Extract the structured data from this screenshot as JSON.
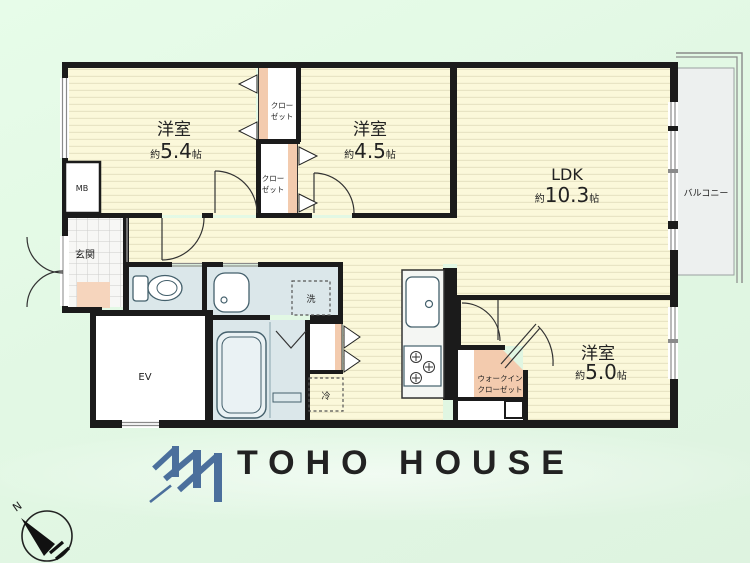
{
  "plan": {
    "room1": {
      "name": "洋室",
      "area_prefix": "約",
      "area_value": "5.4",
      "area_unit": "帖"
    },
    "room2": {
      "name": "洋室",
      "area_prefix": "約",
      "area_value": "4.5",
      "area_unit": "帖"
    },
    "ldk": {
      "name": "LDK",
      "area_prefix": "約",
      "area_value": "10.3",
      "area_unit": "帖"
    },
    "room3": {
      "name": "洋室",
      "area_prefix": "約",
      "area_value": "5.0",
      "area_unit": "帖"
    },
    "balcony": "バルコニー",
    "entrance": "玄関",
    "meter_box": "MB",
    "elevator": "EV",
    "washer": "洗",
    "fridge": "冷",
    "closet": {
      "line1": "クロー",
      "line2": "ゼット"
    },
    "walk_in_closet": {
      "line1": "ウォークイン",
      "line2": "クローゼット"
    },
    "compass_north": "N"
  },
  "logo": {
    "text": "TOHO HOUSE",
    "color": "#4b6f9c"
  },
  "colors": {
    "background": "#e4f9e6",
    "floor": "#fbf8da",
    "floor_stripe": "#e8e4c4",
    "wall": "#1b1b1b",
    "fixture_blue": "#dbe7ea",
    "closet_pink": "#f3cbae",
    "balcony_gray": "#edf0ef",
    "logo_blue": "#4b6f9c"
  }
}
